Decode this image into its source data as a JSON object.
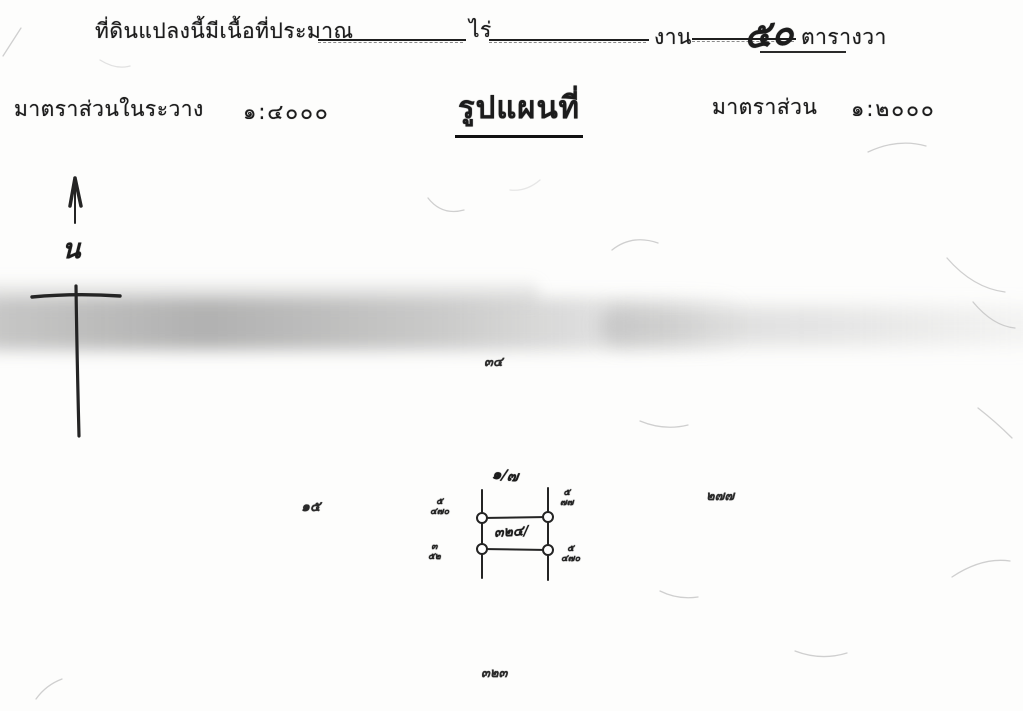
{
  "document": {
    "area_line": {
      "prefix": "ที่ดินแปลงนี้มีเนื้อที่ประมาณ",
      "rai_label": "ไร่",
      "ngan_label": "งาน",
      "square_wa_value": "๕๐",
      "square_wa_label": "ตารางวา"
    },
    "scale_row": {
      "sheet_scale_label": "มาตราส่วนในระวาง",
      "sheet_scale_value": "๑:๔๐๐๐",
      "title": "รูปแผนที่",
      "map_scale_label": "มาตราส่วน",
      "map_scale_value": "๑:๒๐๐๐"
    },
    "compass": {
      "north_label": "น"
    },
    "parcel_sketch": {
      "parcel_number": "๓๒๔/",
      "upper_number": "๑/๗",
      "corner_marks": [
        {
          "position": "top-left",
          "text": "๕\n๔๗๐"
        },
        {
          "position": "top-right",
          "text": "๕\n๗๗"
        },
        {
          "position": "bottom-left",
          "text": "๓\n๕๒"
        },
        {
          "position": "bottom-right",
          "text": "๕\n๔๗๐"
        }
      ]
    },
    "annotations": [
      {
        "id": "sheet-mark",
        "text": "๓๔"
      },
      {
        "id": "left-mark",
        "text": "๑๕"
      },
      {
        "id": "right-mark",
        "text": "๒๗๗"
      },
      {
        "id": "bottom-mark",
        "text": "๓๒๓"
      }
    ]
  },
  "colors": {
    "paper": "#fdfdfc",
    "ink": "#1c1c1c",
    "scan_band": "#9a9a9a",
    "crease": "#cfcfcf"
  }
}
